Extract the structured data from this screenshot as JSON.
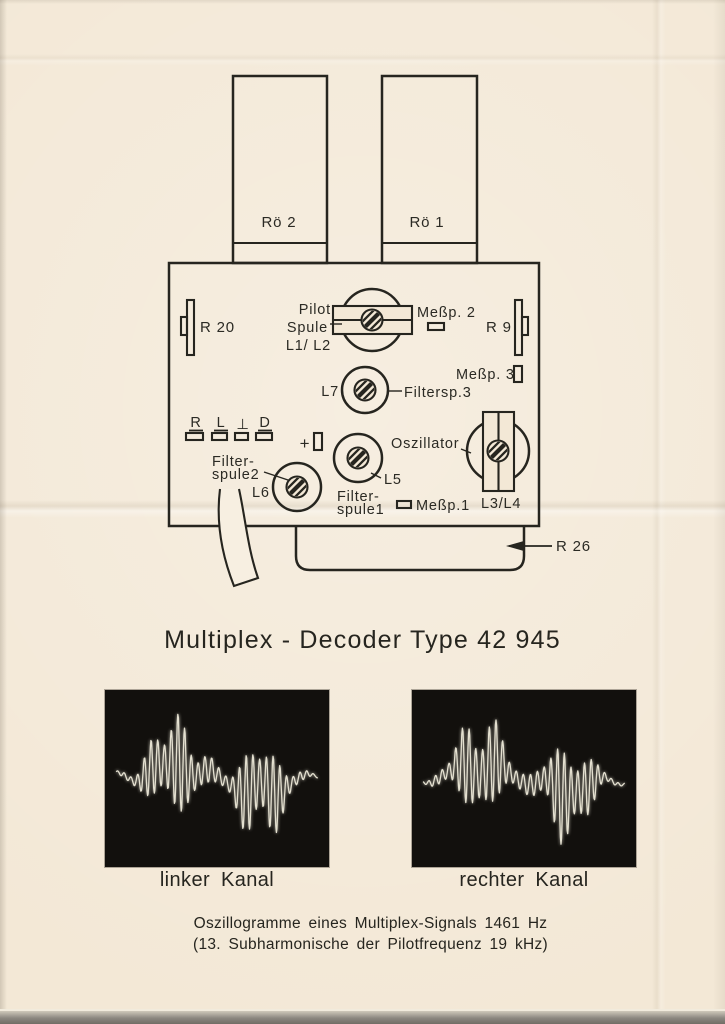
{
  "page": {
    "title": "Multiplex - Decoder Type 42 945",
    "caption": {
      "line1": "Oszillogramme eines Multiplex-Signals 1461 Hz",
      "line2": "(13. Subharmonische der Pilotfrequenz 19 kHz)"
    }
  },
  "diagram": {
    "tubes": [
      {
        "label": "Rö 2"
      },
      {
        "label": "Rö 1"
      }
    ],
    "resistors": {
      "r20": "R 20",
      "r9": "R 9",
      "r26": "R 26"
    },
    "pilot_coil": {
      "line1": "Pilot",
      "line2": "Spule",
      "line3": "L1/ L2"
    },
    "test_points": {
      "mp1": "Meßp.1",
      "mp2": "Meßp. 2",
      "mp3": "Meßp. 3"
    },
    "filter3": {
      "coil": "L7",
      "label": "Filtersp.3"
    },
    "filter1": {
      "coil": "L5",
      "line1": "Filter-",
      "line2": "spule1"
    },
    "filter2": {
      "coil": "L6",
      "line1": "Filter-",
      "line2": "spule2"
    },
    "oscillator": {
      "label": "Oszillator",
      "coil": "L3/L4"
    },
    "jacks": {
      "r": "R",
      "l": "L",
      "gnd": "⊥",
      "d": "D",
      "plus": "+"
    }
  },
  "oscilloscopes": [
    {
      "label": "linker Kanal",
      "phase": 0.4
    },
    {
      "label": "rechter Kanal",
      "phase": 2.6
    }
  ],
  "waveform": {
    "samples": 360,
    "carrier_cycles": 30,
    "burst_up": {
      "center": 0.285,
      "width": 0.15
    },
    "burst_down": {
      "center": 0.715,
      "width": 0.14
    },
    "bias": 0.24,
    "amp": 0.62,
    "ripple": {
      "freq": 6.3,
      "amp": 0.28
    },
    "base_wiggle": {
      "freq": 4.2,
      "amp": 0.07
    },
    "signal_freq_hz": 1461,
    "pilot_freq_khz": 19
  },
  "colors": {
    "paper": "#f3e8d6",
    "ribbon": "#f7efe1",
    "ink": "#26251f",
    "scope_bg": "#12100d",
    "trace": "#e4e0d0"
  }
}
